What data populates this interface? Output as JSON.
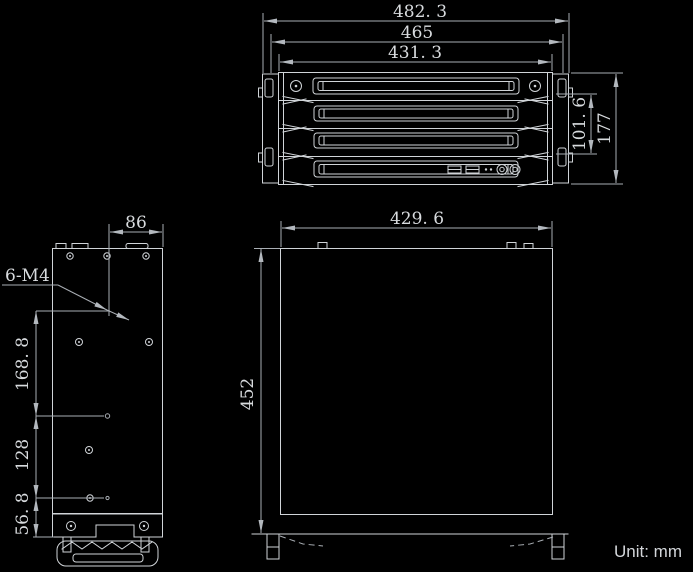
{
  "unit_label": "Unit: mm",
  "colors": {
    "background": "#000000",
    "object_line": "#d0d4d8",
    "dimension_line": "#a9aeb4",
    "text": "#d8dbde"
  },
  "front_view": {
    "width_overall": "482. 3",
    "width_body": "465",
    "width_tray": "431. 3",
    "height_opening": "101. 6",
    "height_overall": "177"
  },
  "side_view": {
    "offset_top": "86",
    "thread_callout": "6-M4",
    "spacing_upper": "168. 8",
    "spacing_middle": "128",
    "spacing_lower": "56. 8"
  },
  "top_view": {
    "width": "429. 6",
    "depth": "452"
  }
}
